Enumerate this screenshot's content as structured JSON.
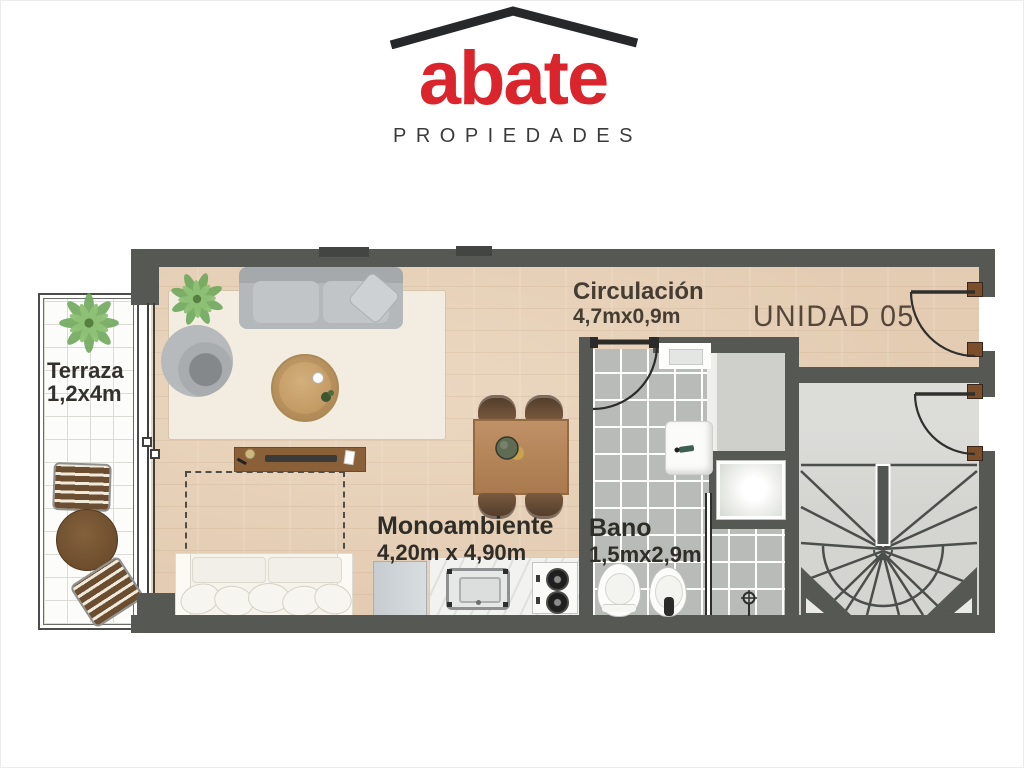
{
  "brand": {
    "name": "abate",
    "tagline": "PROPIEDADES"
  },
  "plan": {
    "unit_label": "UNIDAD 05",
    "rooms": {
      "terraza": {
        "name": "Terraza",
        "dims": "1,2x4m"
      },
      "circulacion": {
        "name": "Circulación",
        "dims": "4,7mx0,9m"
      },
      "monoambiente": {
        "name": "Monoambiente",
        "dims": "4,20m x 4,90m"
      },
      "bano": {
        "name": "Bano",
        "dims": "1,5mx2,9m"
      }
    }
  },
  "colors": {
    "brand_red": "#d9252b",
    "roof_black": "#26282a",
    "wall_gray": "#565854",
    "wood_floor": "#e3ccb2",
    "bath_tile": "#b9bbb8",
    "landing_gray": "#d4d4d1",
    "terrace_tile": "#fcfcfa",
    "rug_cream": "#f2ede0",
    "label_text": "#33312b"
  }
}
